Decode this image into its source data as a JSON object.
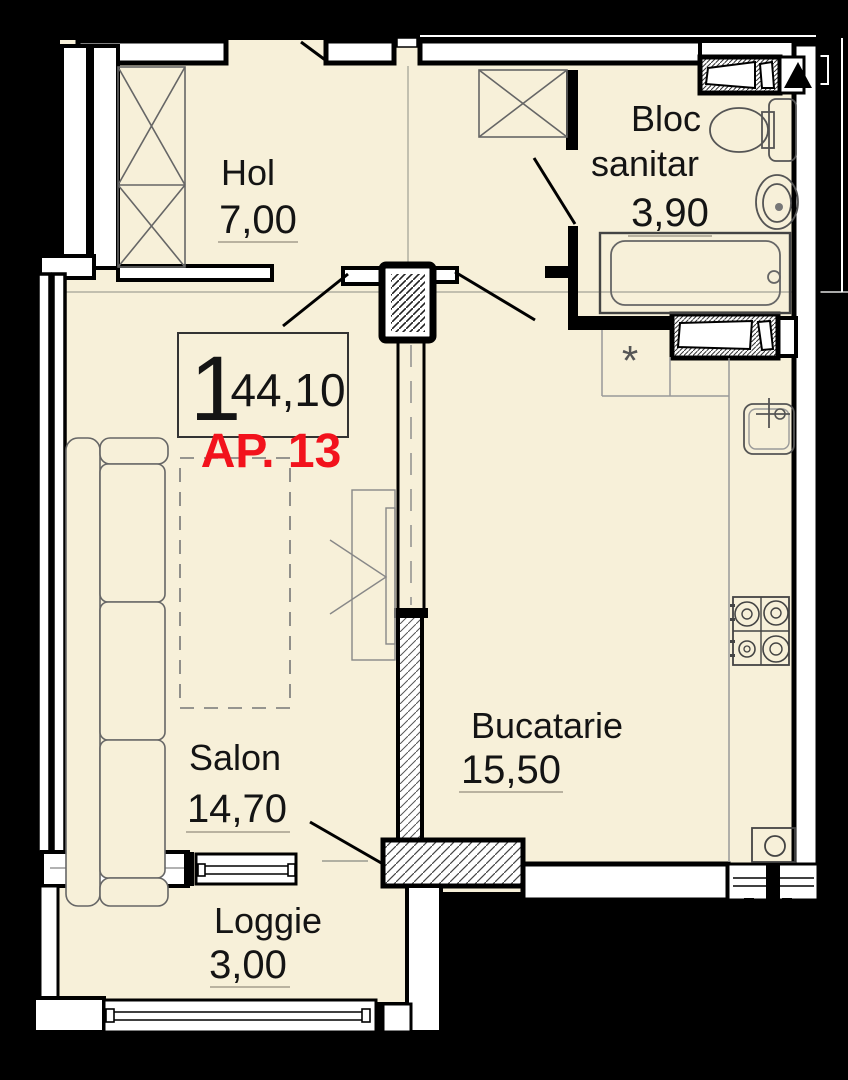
{
  "plan": {
    "apartment": {
      "rooms_count": "1",
      "total_area": "44,10",
      "label": "AP. 13"
    },
    "rooms": [
      {
        "id": "hol",
        "name": "Hol",
        "area": "7,00"
      },
      {
        "id": "bloc-sanitar",
        "name_line1": "Bloc",
        "name_line2": "sanitar",
        "area": "3,90"
      },
      {
        "id": "salon",
        "name": "Salon",
        "area": "14,70"
      },
      {
        "id": "bucatarie",
        "name": "Bucatarie",
        "area": "15,50"
      },
      {
        "id": "loggie",
        "name": "Loggie",
        "area": "3,00"
      }
    ],
    "annotations": {
      "vent_mark": "*"
    },
    "colors": {
      "floor": "#f7f0d9",
      "outside": "#000000",
      "accent_red": "#f2121c",
      "line": "#141414"
    }
  }
}
